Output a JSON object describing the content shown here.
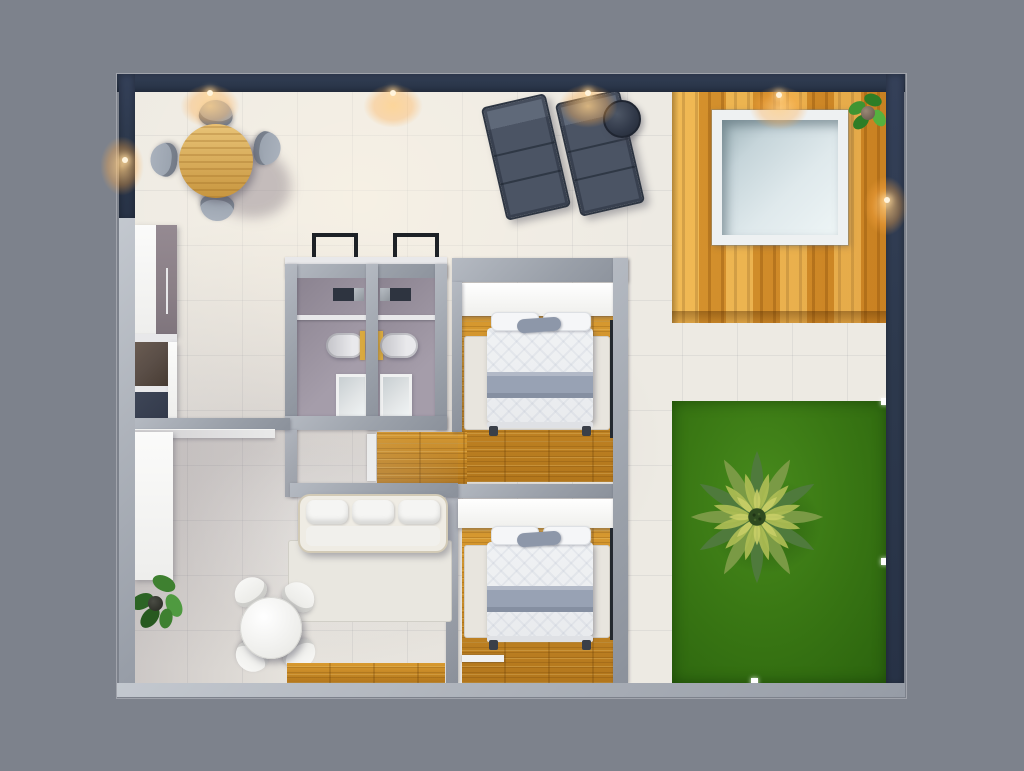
{
  "scene": {
    "type": "3d-floor-plan-top-down-render",
    "rooms": [
      "dining-terrace",
      "kitchen",
      "bathroom-left",
      "bathroom-right",
      "bedroom-top",
      "bedroom-bottom",
      "hallway",
      "living-room",
      "wood-deck",
      "lawn-garden"
    ],
    "objects": [
      "round-wood-dining-table",
      "4-gray-dining-chairs",
      "2-sun-loungers",
      "round-dark-side-table",
      "plunge-pool",
      "deck-plant",
      "palm-tree",
      "3-garden-lights",
      "2-beds-with-gray-blanket",
      "2-wardrobes",
      "2-bathtubs",
      "2-showers",
      "2-vanities",
      "2-window-frames",
      "kitchen-cabinet",
      "cooktop-unit",
      "sink-unit",
      "white-sofa",
      "round-white-table",
      "4-white-chairs",
      "storage-cabinet",
      "floor-plant",
      "6-wall-sconce-lights",
      "3-white-interior-doors"
    ],
    "wall_sconce_count": 6,
    "garden_light_count": 3
  },
  "colors": {
    "bg": "#7d828c",
    "wall-dark": "#2e3a4e",
    "wall-light": "#aeb3bb",
    "wall-mid": "#9aa0a9",
    "floor-cream": "#edeae3",
    "wood-deck": "#e6a33b",
    "wood-floor": "#cf9029",
    "wood-floor-dark": "#b2761c",
    "lawn": "#3a7814",
    "lawn-dark": "#2b630e",
    "pool-rim": "#eef1f2",
    "pool-water": "#dfe9ec",
    "pool-shadow": "#9fb4ba",
    "bath-floor": "#a59daa",
    "bath-floor-dark": "#8b8390",
    "duvet": "#e9ebee",
    "blanket": "#98a2b4",
    "pillow": "#f5f6f8",
    "rug": "#e8e5de",
    "lounger": "#4b5464",
    "lounger-light": "#5f6979",
    "round-dark": "#323a4a",
    "taupe": "#8a7f86",
    "appliance-brown": "#5a4e47",
    "appliance-navy": "#333a4b",
    "door-slot": "#23282f",
    "window-frame": "#1d2126",
    "gold": "#d9a93f",
    "shower": "#e3e6e7",
    "table-wood": "#dcb266",
    "table-wood-dark": "#c8963f",
    "chair-gray": "#97a0ac",
    "sofa-frame": "#efece4",
    "palm-dark": "#4f7a3c",
    "palm-mid": "#7a9a45",
    "palm-light": "#aebd55",
    "palm-pale": "#c9cf68",
    "palm-center": "#2f4a20",
    "plant-green": "#3e8030",
    "plant-dark": "#27591f"
  }
}
